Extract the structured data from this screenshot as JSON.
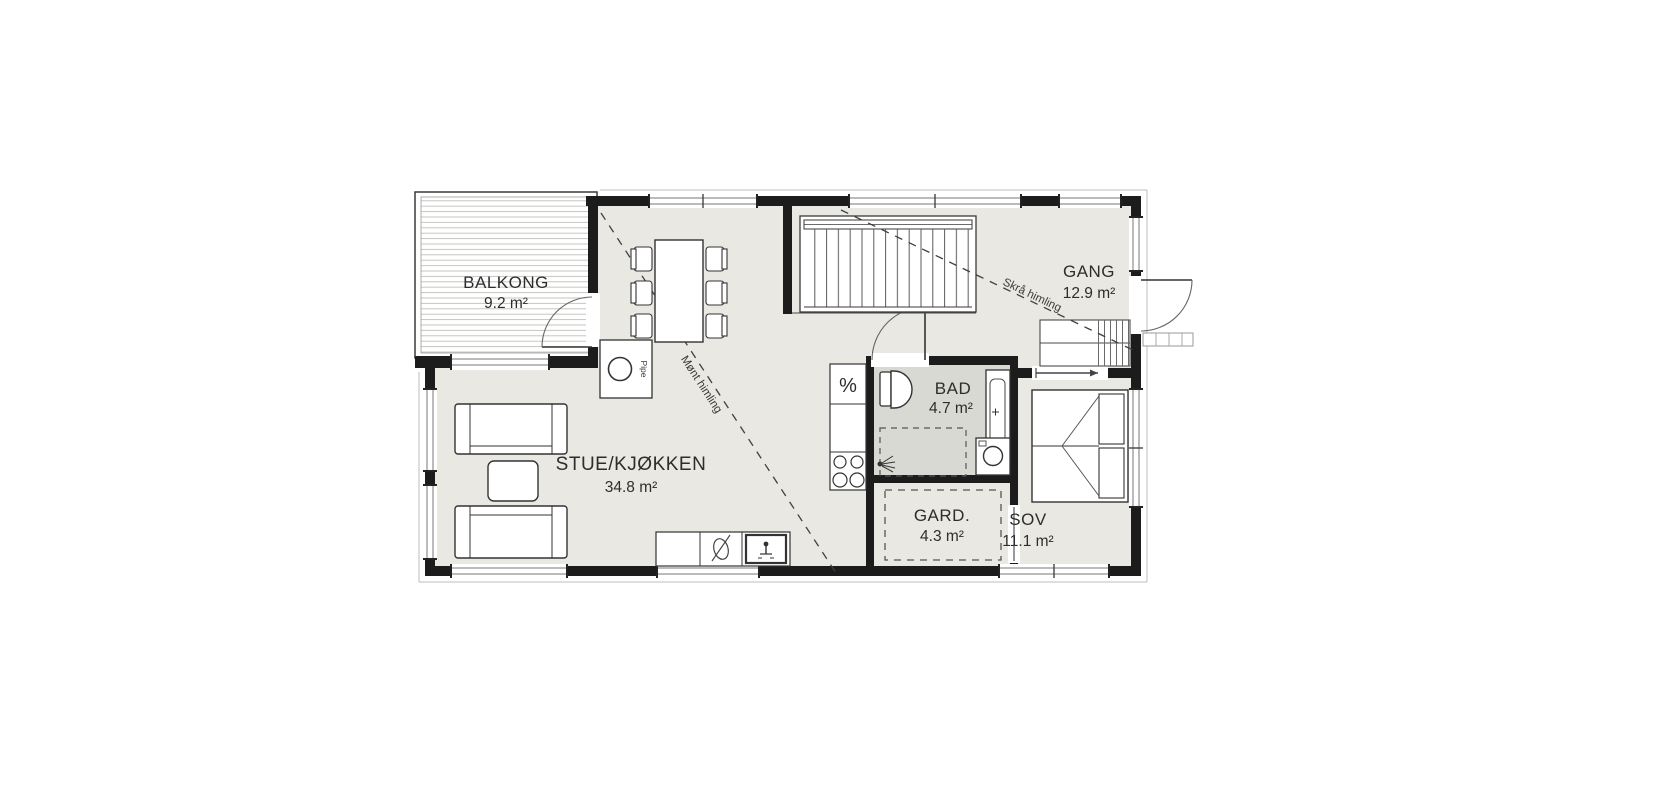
{
  "drawing": {
    "type": "architectural floor plan",
    "rooms": {
      "balkong": {
        "name": "BALKONG",
        "area": "9.2 m²"
      },
      "stue_kjokken": {
        "name": "STUE/KJØKKEN",
        "area": "34.8 m²"
      },
      "bad": {
        "name": "BAD",
        "area": "4.7 m²"
      },
      "gard": {
        "name": "GARD.",
        "area": "4.3 m²"
      },
      "sov": {
        "name": "SOV",
        "area": "11.1 m²"
      },
      "gang": {
        "name": "GANG",
        "area": "12.9 m²"
      }
    },
    "annotations": {
      "ceiling_line_1": "Mønt himling",
      "ceiling_line_2": "Skrå himling",
      "chimney": "Pipe"
    },
    "icons": [
      "dining-table",
      "dining-chair",
      "sofa",
      "coffee-table",
      "stairs",
      "kitchen-counter",
      "cooktop",
      "kitchen-sink",
      "toilet",
      "shower-head",
      "washing-machine",
      "vanity-sink",
      "double-bed",
      "door-swing-arc",
      "window",
      "chimney",
      "sliding-door",
      "entry-step"
    ],
    "colors": {
      "wall": "#1c1c1c",
      "floor": "#e9e8e2",
      "bath_floor": "#d9d9d3",
      "balcony_hatch": "#c6c6c0",
      "line": "#3c3c3c",
      "text": "#2d2d2d",
      "background": "#ffffff"
    }
  }
}
